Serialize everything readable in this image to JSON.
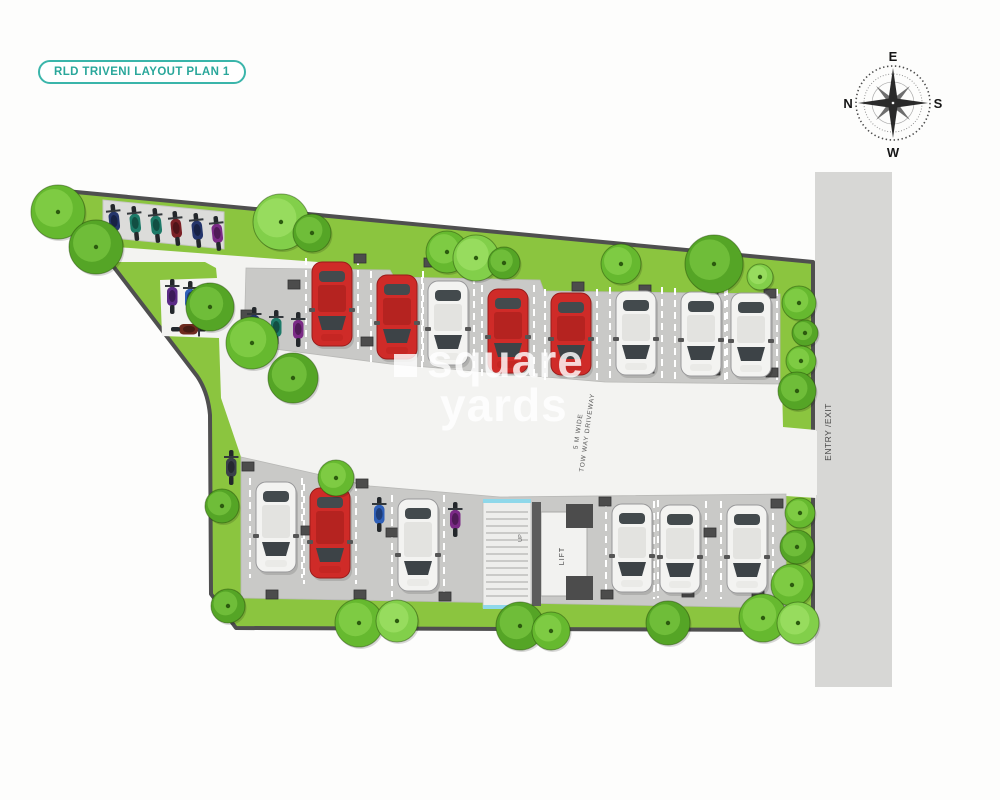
{
  "badge": {
    "label": "RLD TRIVENI LAYOUT PLAN 1"
  },
  "compass": {
    "top": "E",
    "right": "S",
    "bottom": "W",
    "left": "N"
  },
  "watermark": {
    "word1": "square",
    "word2": "yards"
  },
  "labels": {
    "driveway_line1": "5 M WIDE",
    "driveway_line2": "TOW WAY DRIVEWAY",
    "entry_exit": "ENTRY /EXIT",
    "lift": "LIFT",
    "up": "UP"
  },
  "colors": {
    "badge_teal": "#2aa79b",
    "grass": "#8bc53f",
    "boundary": "#4f4f4f",
    "pad": "#c9c9c7",
    "bike_pad": "#dcdcda",
    "driveway": "#f3f3f1",
    "road": "#d7d7d5",
    "column": "#4c4c4c",
    "car_red": "#cf2b28",
    "car_white": "#f3f3f1",
    "stair_blue": "#8fd8ea"
  },
  "plan": {
    "cars": [
      {
        "x": 312,
        "y": 262,
        "h": 84,
        "c": "red"
      },
      {
        "x": 377,
        "y": 275,
        "h": 84,
        "c": "red"
      },
      {
        "x": 428,
        "y": 281,
        "h": 84,
        "c": "white"
      },
      {
        "x": 488,
        "y": 289,
        "h": 84,
        "c": "red"
      },
      {
        "x": 551,
        "y": 293,
        "h": 82,
        "c": "red"
      },
      {
        "x": 616,
        "y": 291,
        "h": 84,
        "c": "white"
      },
      {
        "x": 681,
        "y": 292,
        "h": 84,
        "c": "white"
      },
      {
        "x": 731,
        "y": 293,
        "h": 84,
        "c": "white"
      },
      {
        "x": 256,
        "y": 482,
        "h": 90,
        "c": "white"
      },
      {
        "x": 310,
        "y": 488,
        "h": 90,
        "c": "red"
      },
      {
        "x": 398,
        "y": 499,
        "h": 92,
        "c": "white"
      },
      {
        "x": 612,
        "y": 504,
        "h": 88,
        "c": "white"
      },
      {
        "x": 660,
        "y": 505,
        "h": 88,
        "c": "white"
      },
      {
        "x": 727,
        "y": 505,
        "h": 88,
        "c": "white"
      }
    ],
    "bikes": [
      {
        "x": 108,
        "y": 204,
        "c": "#24356b",
        "r": -6
      },
      {
        "x": 129,
        "y": 206,
        "c": "#1d7a68",
        "r": -6
      },
      {
        "x": 150,
        "y": 208,
        "c": "#1d7a68",
        "r": -6
      },
      {
        "x": 170,
        "y": 211,
        "c": "#7a2025",
        "r": -6
      },
      {
        "x": 191,
        "y": 213,
        "c": "#24356b",
        "r": -6
      },
      {
        "x": 211,
        "y": 216,
        "c": "#7b2a86",
        "r": -6
      },
      {
        "x": 166,
        "y": 279,
        "c": "#5b2a86"
      },
      {
        "x": 184,
        "y": 281,
        "c": "#2e5fb8"
      },
      {
        "x": 202,
        "y": 283,
        "c": "#315a3c"
      },
      {
        "x": 183,
        "y": 312,
        "c": "#6e2a1e",
        "o": "h"
      },
      {
        "x": 248,
        "y": 307,
        "c": "#24356b"
      },
      {
        "x": 270,
        "y": 310,
        "c": "#1d7a68"
      },
      {
        "x": 292,
        "y": 312,
        "c": "#7b2a86"
      },
      {
        "x": 225,
        "y": 450,
        "c": "#3a3f4a"
      },
      {
        "x": 373,
        "y": 497,
        "c": "#2e5fb8"
      },
      {
        "x": 449,
        "y": 502,
        "c": "#7b2a86"
      }
    ],
    "trees": [
      [
        58,
        212,
        27,
        0
      ],
      [
        96,
        247,
        27,
        1
      ],
      [
        281,
        222,
        28,
        2
      ],
      [
        312,
        233,
        19,
        1
      ],
      [
        447,
        252,
        21,
        0
      ],
      [
        476,
        258,
        23,
        2
      ],
      [
        504,
        263,
        16,
        1
      ],
      [
        621,
        264,
        20,
        0
      ],
      [
        714,
        264,
        29,
        1
      ],
      [
        760,
        277,
        13,
        2
      ],
      [
        210,
        307,
        24,
        1
      ],
      [
        252,
        343,
        26,
        0
      ],
      [
        293,
        378,
        25,
        1
      ],
      [
        222,
        506,
        17,
        1
      ],
      [
        336,
        478,
        18,
        0
      ],
      [
        799,
        303,
        17,
        0
      ],
      [
        805,
        333,
        13,
        1
      ],
      [
        801,
        361,
        15,
        0
      ],
      [
        797,
        391,
        19,
        1
      ],
      [
        800,
        513,
        15,
        0
      ],
      [
        797,
        547,
        17,
        1
      ],
      [
        792,
        585,
        21,
        0
      ],
      [
        228,
        606,
        17,
        1
      ],
      [
        359,
        623,
        24,
        0
      ],
      [
        397,
        621,
        21,
        2
      ],
      [
        520,
        626,
        24,
        1
      ],
      [
        551,
        631,
        19,
        0
      ],
      [
        668,
        623,
        22,
        1
      ],
      [
        763,
        618,
        24,
        0
      ],
      [
        798,
        623,
        21,
        2
      ]
    ],
    "columns": [
      [
        360,
        258
      ],
      [
        430,
        262
      ],
      [
        505,
        268
      ],
      [
        578,
        286
      ],
      [
        645,
        289
      ],
      [
        712,
        291
      ],
      [
        770,
        293
      ],
      [
        367,
        341
      ],
      [
        437,
        348
      ],
      [
        512,
        356
      ],
      [
        581,
        365
      ],
      [
        648,
        368
      ],
      [
        714,
        370
      ],
      [
        772,
        372
      ],
      [
        247,
        314
      ],
      [
        294,
        284
      ],
      [
        248,
        466
      ],
      [
        362,
        483
      ],
      [
        307,
        530
      ],
      [
        392,
        532
      ],
      [
        605,
        501
      ],
      [
        710,
        532
      ],
      [
        777,
        503
      ],
      [
        272,
        594
      ],
      [
        360,
        594
      ],
      [
        445,
        596
      ],
      [
        607,
        594
      ],
      [
        688,
        592
      ],
      [
        758,
        593
      ]
    ]
  }
}
